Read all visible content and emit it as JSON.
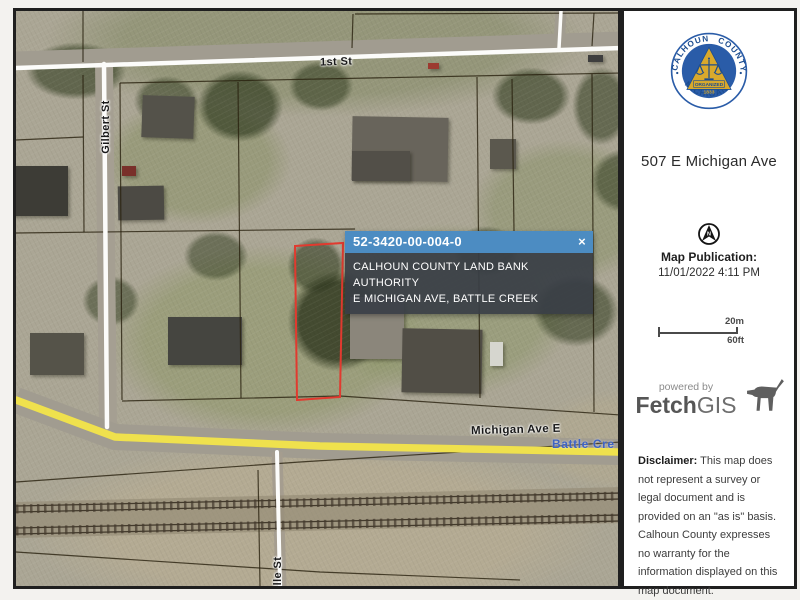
{
  "map": {
    "labels": {
      "first_st": "1st St",
      "gilbert_st": "Gilbert St",
      "michigan_ave": "Michigan Ave E",
      "ville_st": "ville St",
      "battle_creek": "Battle Cre"
    },
    "popup": {
      "parcel_id": "52-3420-00-004-0",
      "close_glyph": "×",
      "owner_line": "CALHOUN COUNTY LAND BANK AUTHORITY",
      "address_line": "E MICHIGAN AVE, BATTLE CREEK"
    },
    "colors": {
      "parcel_highlight": "#e13a2f",
      "popup_header": "#4c8cc2",
      "popup_body": "#3a4046",
      "road_yellow": "#efe14d"
    }
  },
  "sidebar": {
    "seal": {
      "arc_left": "CALHOUN",
      "arc_right": "COUNTY",
      "arc_bottom": "MICHIGAN",
      "banner": "ORGANIZED",
      "year": "1833"
    },
    "address_title": "507 E Michigan Ave",
    "north_letter": "N",
    "publication_label": "Map Publication:",
    "publication_datetime": "11/01/2022 4:11 PM",
    "scalebar": {
      "metric": "20m",
      "imperial": "60ft"
    },
    "branding": {
      "powered_by": "powered by",
      "name_bold": "Fetch",
      "name_regular": "GIS"
    },
    "disclaimer": {
      "label": "Disclaimer:",
      "text": " This map does not represent a survey or legal document and is provided on an \"as is\" basis. Calhoun County expresses no warranty for the information displayed on this map document."
    }
  }
}
